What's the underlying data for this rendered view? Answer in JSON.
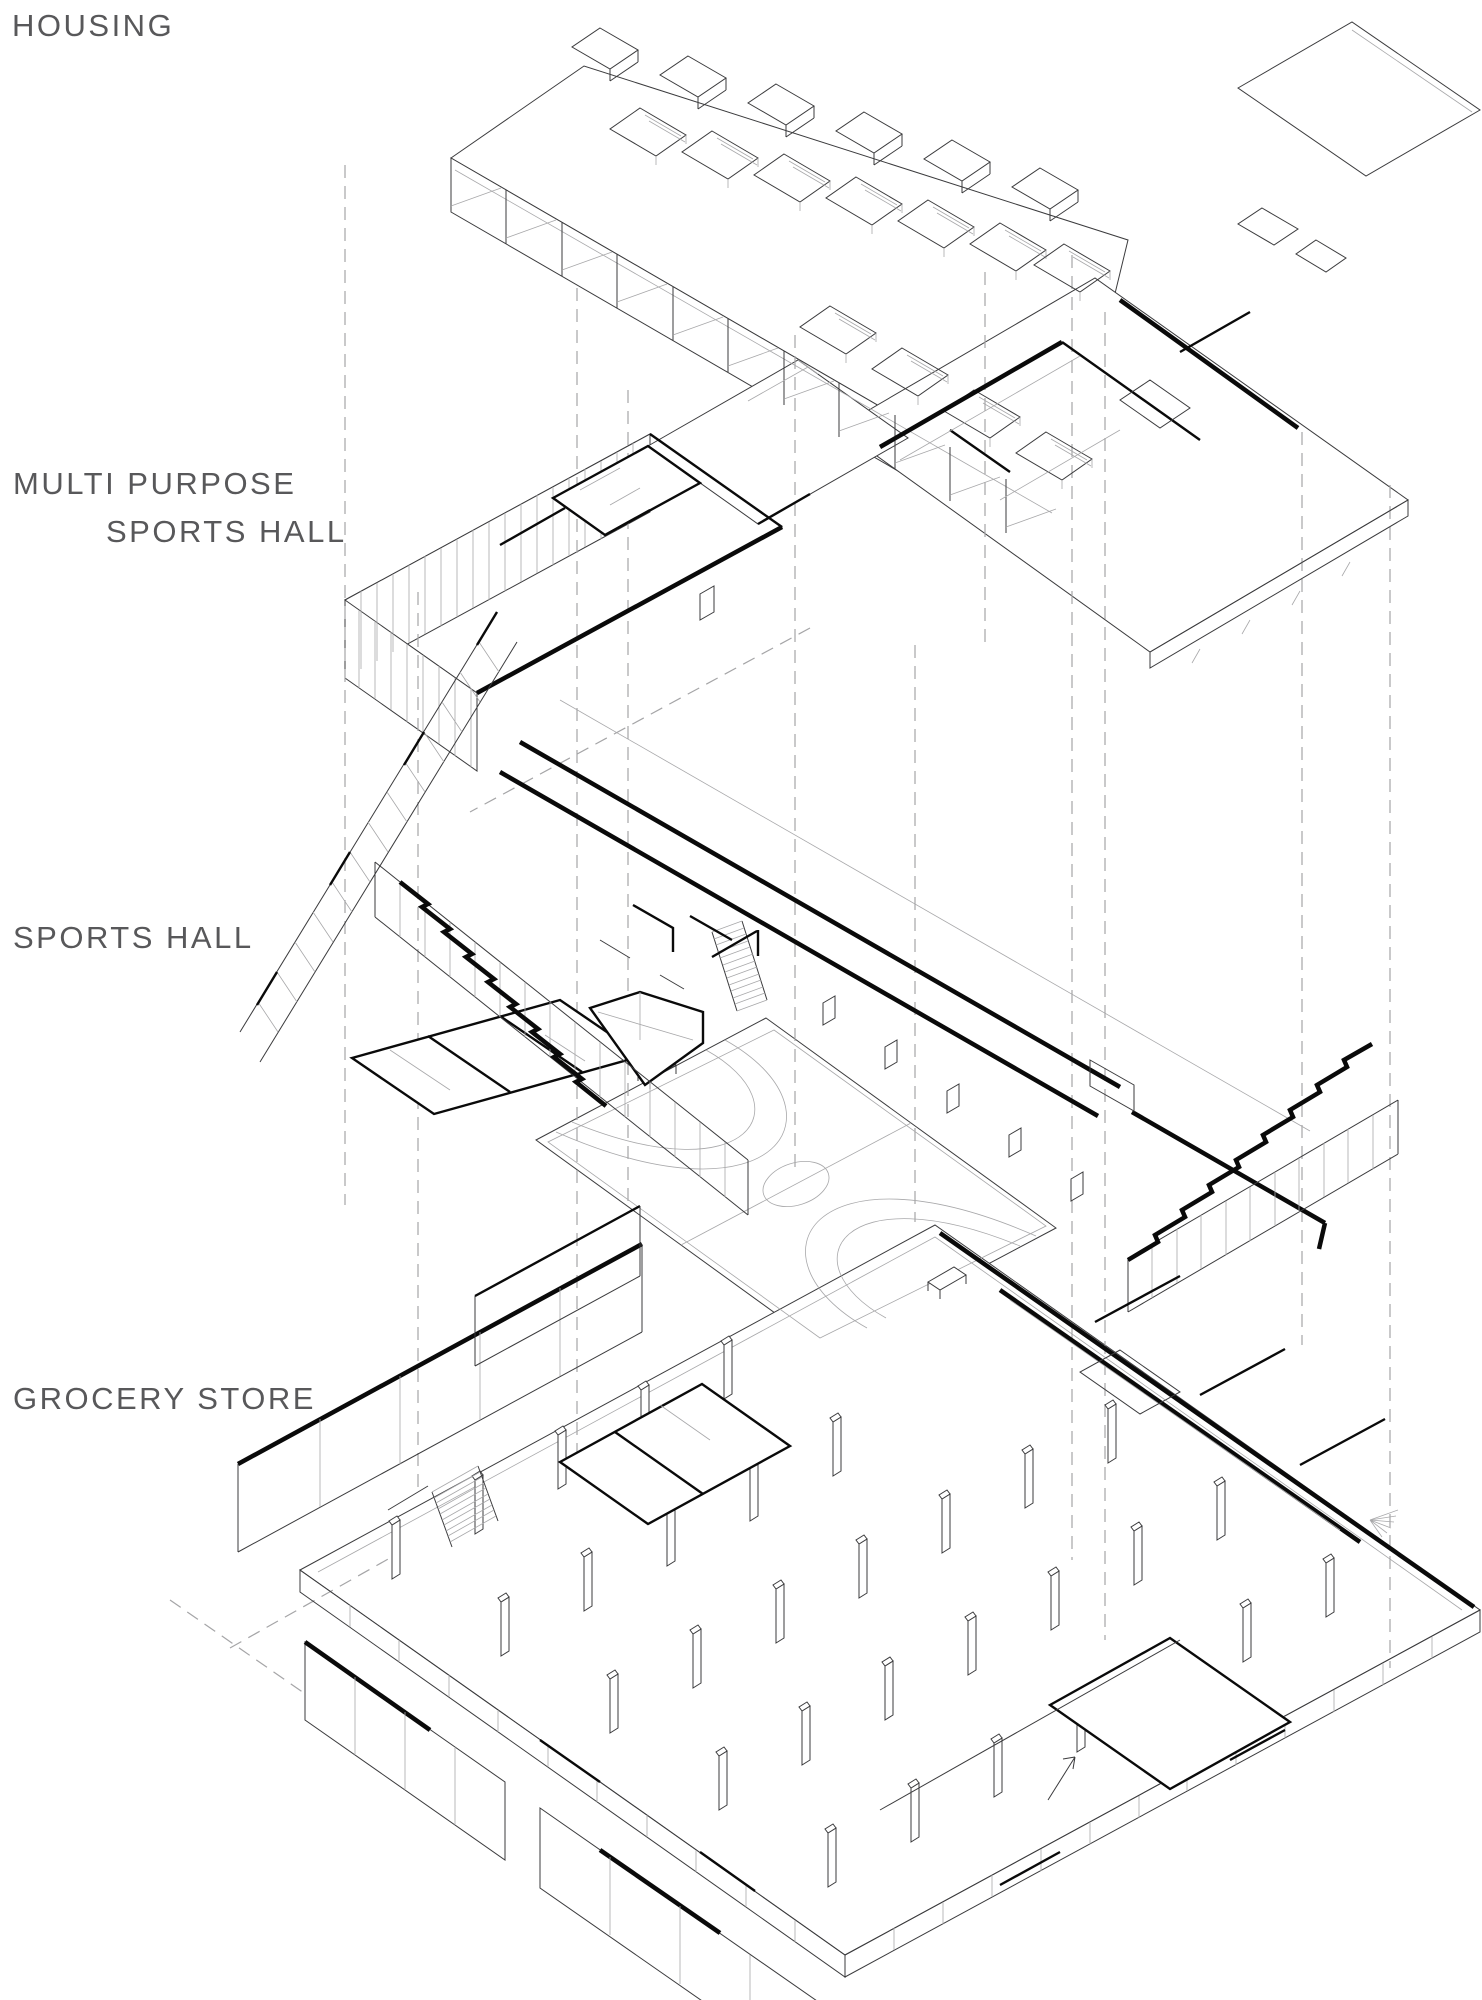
{
  "labels": {
    "housing": "HOUSING",
    "multi_purpose_line1": "MULTI PURPOSE",
    "multi_purpose_line2": "SPORTS HALL",
    "sports_hall": "SPORTS HALL",
    "grocery_store": "GROCERY STORE"
  },
  "layers": [
    {
      "id": "housing",
      "label": "HOUSING"
    },
    {
      "id": "multi-purpose-sports-hall",
      "label": "MULTI PURPOSE SPORTS HALL"
    },
    {
      "id": "sports-hall",
      "label": "SPORTS HALL"
    },
    {
      "id": "grocery-store",
      "label": "GROCERY STORE"
    }
  ],
  "colors": {
    "background": "#ffffff",
    "line": "#3b3b3d",
    "heavy_line": "#0a0a0a",
    "light_line": "#a8a8aa",
    "dashed_line": "#a5a5a7",
    "label_text": "#58585a"
  }
}
